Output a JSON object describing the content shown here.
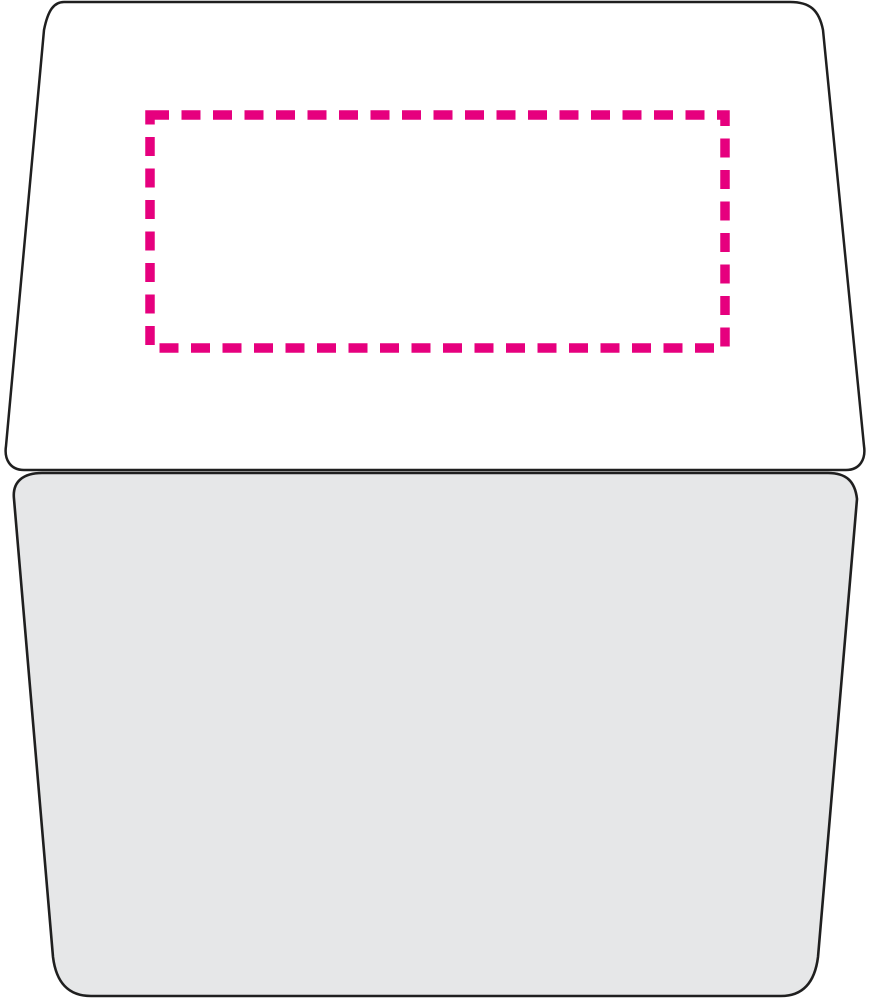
{
  "canvas": {
    "width": 870,
    "height": 1000,
    "background_color": "#ffffff"
  },
  "colors": {
    "outline": "#1f1f1f",
    "lid_fill": "#ffffff",
    "body_fill": "#e6e7e8",
    "print_area": "#e6007e"
  },
  "shapes": {
    "lid": {
      "path": "M 64,2 L 790,2 C 810,2 819,10 823,30 L 864,446 C 866,459 860,470 846,470 L 24,470 C 10,470 4,459 6,446 L 44,30 C 48,10 54,2 64,2 Z",
      "stroke_width": 2.5
    },
    "body": {
      "path": "M 42,473 L 828,473 C 846,473 855,481 857,499 L 818,957 C 815,981 804,996 781,996 L 91,996 C 67,996 56,981 53,957 L 14,499 C 12,481 24,473 42,473 Z",
      "stroke_width": 2.6
    },
    "print_area": {
      "x": 150,
      "y": 115,
      "width": 575,
      "height": 233,
      "stroke_width": 9.5,
      "dash_pattern": "19 12.5"
    }
  }
}
